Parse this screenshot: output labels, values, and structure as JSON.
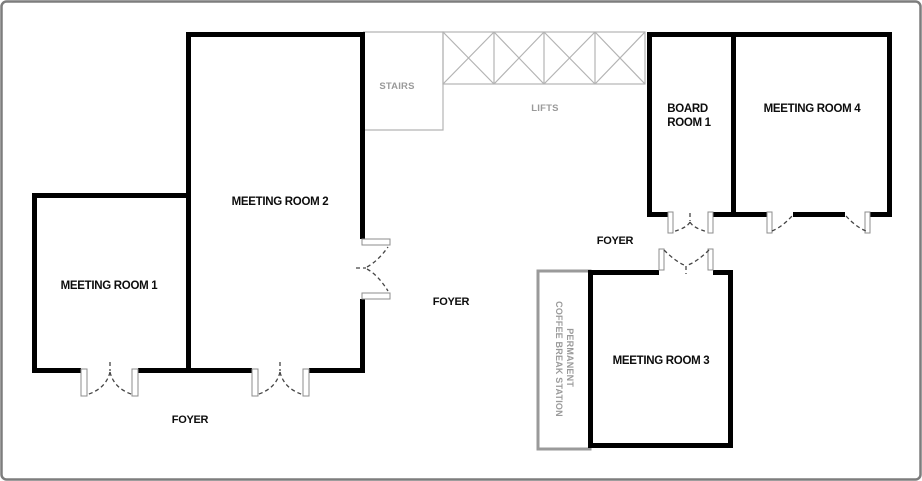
{
  "colors": {
    "background": "#ffffff",
    "page_border": "#7d7d7d",
    "wall": "#000000",
    "gray_line": "#b3b3b3",
    "gray_text": "#9a9a9a",
    "label_text": "#0d0d0d",
    "door_dash": "#444444",
    "jamb_stroke": "#8c8c8c",
    "coffee_border": "#9a9a9a"
  },
  "rooms": {
    "meeting_room_1": {
      "label": "MEETING ROOM 1"
    },
    "meeting_room_2": {
      "label": "MEETING ROOM 2"
    },
    "meeting_room_3": {
      "label": "MEETING ROOM 3"
    },
    "meeting_room_4": {
      "label": "MEETING ROOM 4"
    },
    "board_room_1": {
      "label_line1": "BOARD",
      "label_line2": "ROOM 1"
    }
  },
  "areas": {
    "stairs": {
      "label": "STAIRS"
    },
    "lifts": {
      "label": "LIFTS"
    },
    "foyer_lower_left": {
      "label": "FOYER"
    },
    "foyer_center": {
      "label": "FOYER"
    },
    "foyer_upper_right": {
      "label": "FOYER"
    },
    "coffee_station": {
      "label_line1": "PERMANENT",
      "label_line2": "COFFEE BREAK STATION"
    }
  }
}
